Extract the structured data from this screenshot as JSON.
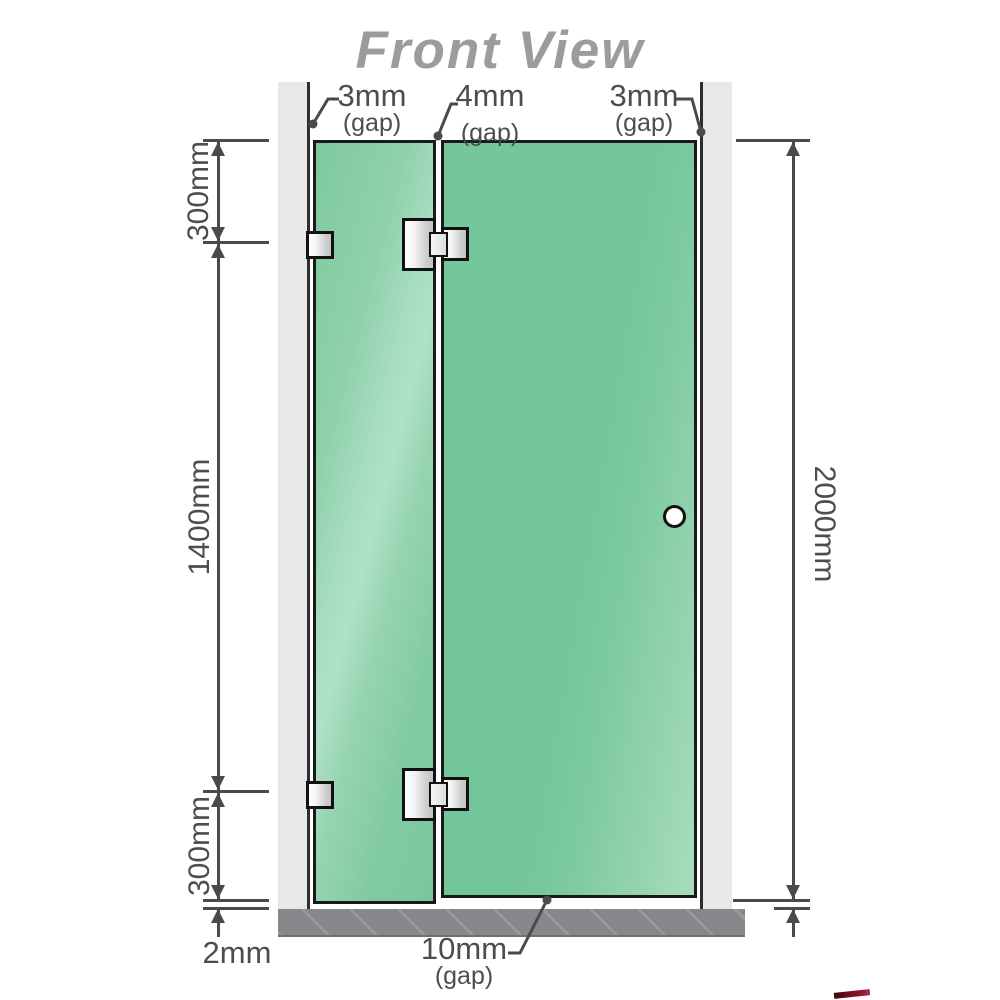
{
  "title": "Front View",
  "gaps": {
    "top_left": {
      "value": "3mm",
      "label": "(gap)"
    },
    "top_middle": {
      "value": "4mm",
      "label": "(gap)"
    },
    "top_right": {
      "value": "3mm",
      "label": "(gap)"
    },
    "bottom": {
      "value": "10mm",
      "label": "(gap)"
    }
  },
  "dimensions": {
    "left_top": "300mm",
    "left_middle": "1400mm",
    "left_bottom": "300mm",
    "right_total": "2000mm",
    "floor_gap": "2mm"
  },
  "colors": {
    "glass_green": "#7bc89e",
    "glass_highlight": "#a8dec2",
    "wall_gray": "#e8e8e8",
    "floor_gray": "#85878b",
    "dimension_line": "#4a4a4a",
    "title_gray": "#9c9c9c",
    "hardware_silver": "#d9d9d9",
    "outline_black": "#1a1a1a",
    "watermark_red": "#8c1326"
  }
}
